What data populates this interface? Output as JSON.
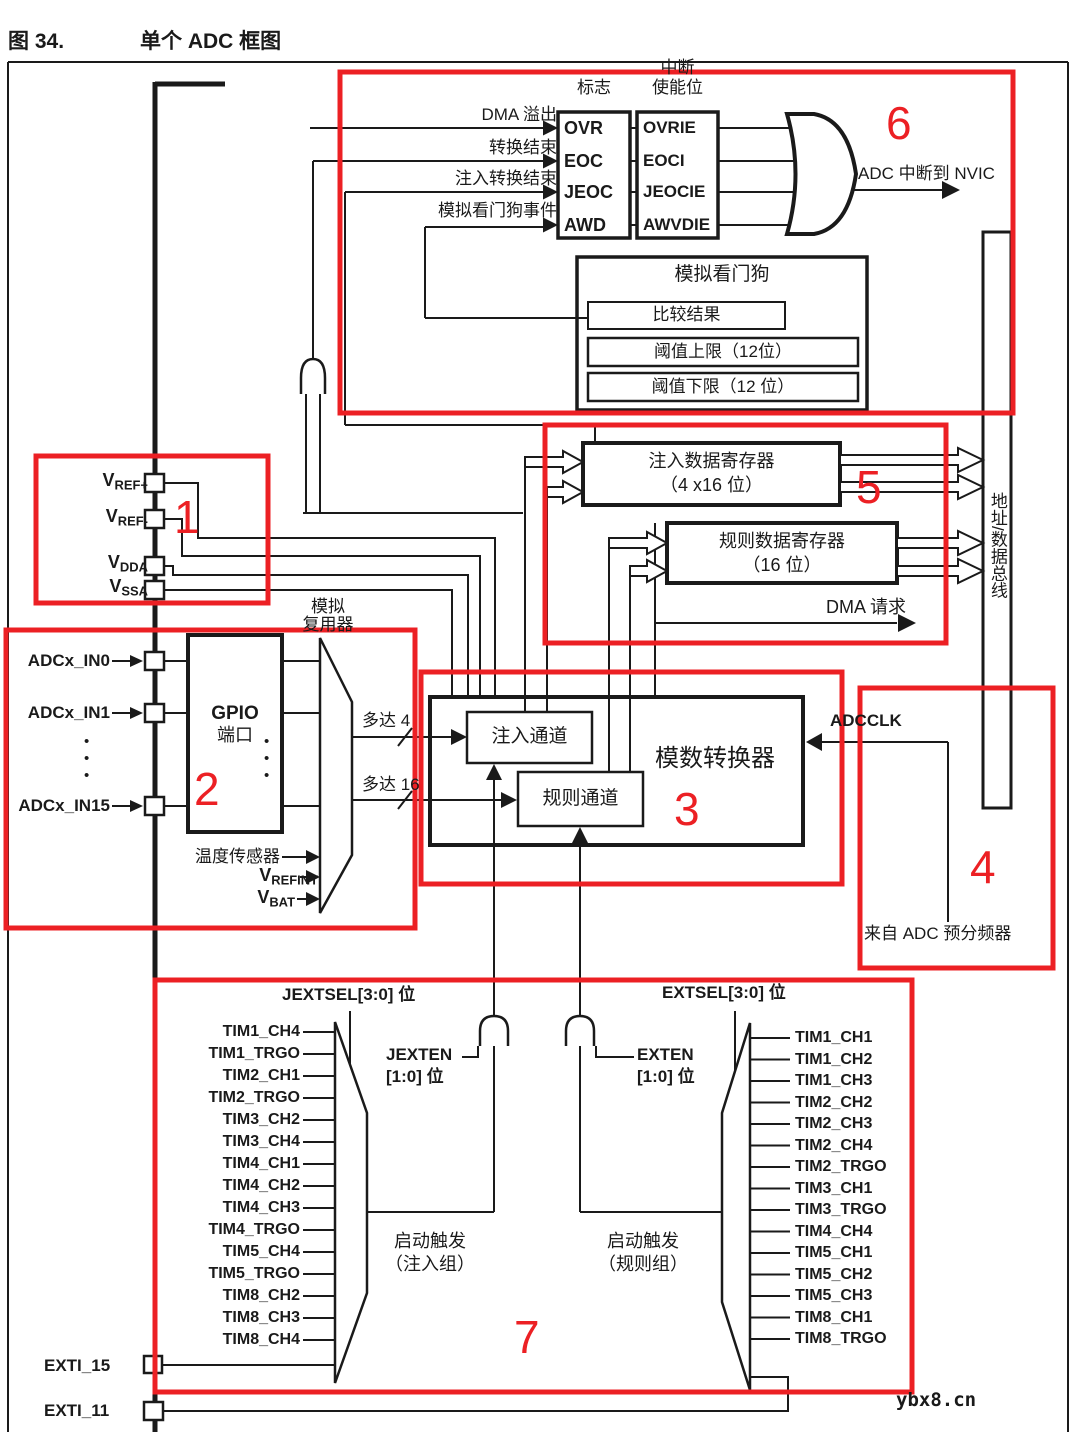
{
  "title": {
    "figure_label": "图 34.",
    "figure_title": "单个 ADC 框图"
  },
  "colors": {
    "annotation_red": "#ec2024",
    "line_black": "#1a1a1a"
  },
  "watermark": "ybx8.cn",
  "interrupt_section": {
    "flags_header": "标志",
    "enable_header_line1": "中断",
    "enable_header_line2": "使能位",
    "rows": [
      {
        "event": "DMA 溢出",
        "flag": "OVR",
        "enable": "OVRIE"
      },
      {
        "event": "转换结束",
        "flag": "EOC",
        "enable": "EOCI"
      },
      {
        "event": "注入转换结束",
        "flag": "JEOC",
        "enable": "JEOCIE"
      },
      {
        "event": "模拟看门狗事件",
        "flag": "AWD",
        "enable": "AWVDIE"
      }
    ],
    "output_label": "ADC 中断到 NVIC"
  },
  "watchdog": {
    "title": "模拟看门狗",
    "compare_result": "比较结果",
    "upper_threshold": "阈值上限（12位）",
    "lower_threshold": "阈值下限（12 位）"
  },
  "registers": {
    "injected_line1": "注入数据寄存器",
    "injected_line2": "（4 x16 位）",
    "regular_line1": "规则数据寄存器",
    "regular_line2": "（16 位）",
    "dma_request": "DMA 请求",
    "bus_label": "地址/数据总线"
  },
  "power_pins": [
    {
      "base": "V",
      "sub": "REF+"
    },
    {
      "base": "V",
      "sub": "REF-"
    },
    {
      "base": "V",
      "sub": "DDA"
    },
    {
      "base": "V",
      "sub": "SSA"
    }
  ],
  "analog_inputs": {
    "in0": "ADCx_IN0",
    "in1": "ADCx_IN1",
    "in15": "ADCx_IN15",
    "gpio_line1": "GPIO",
    "gpio_line2": "端口",
    "mux_label_line1": "模拟",
    "mux_label_line2": "复用器",
    "up_to_4": "多达 4",
    "up_to_16": "多达 16",
    "temp_sensor": "温度传感器",
    "vrefint_base": "V",
    "vrefint_sub": "REFINT",
    "vbat_base": "V",
    "vbat_sub": "BAT"
  },
  "adc_core": {
    "title": "模数转换器",
    "injected": "注入通道",
    "regular": "规则通道"
  },
  "clock": {
    "adcclk": "ADCCLK",
    "source": "来自 ADC 预分频器"
  },
  "triggers": {
    "jextsel": "JEXTSEL[3:0] 位",
    "extsel": "EXTSEL[3:0] 位",
    "jexten_line1": "JEXTEN",
    "jexten_line2": "[1:0] 位",
    "exten_line1": "EXTEN",
    "exten_line2": "[1:0] 位",
    "injected_trigger_line1": "启动触发",
    "injected_trigger_line2": "（注入组）",
    "regular_trigger_line1": "启动触发",
    "regular_trigger_line2": "（规则组）",
    "injected_inputs": [
      "TIM1_CH4",
      "TIM1_TRGO",
      "TIM2_CH1",
      "TIM2_TRGO",
      "TIM3_CH2",
      "TIM3_CH4",
      "TIM4_CH1",
      "TIM4_CH2",
      "TIM4_CH3",
      "TIM4_TRGO",
      "TIM5_CH4",
      "TIM5_TRGO",
      "TIM8_CH2",
      "TIM8_CH3",
      "TIM8_CH4"
    ],
    "regular_inputs": [
      "TIM1_CH1",
      "TIM1_CH2",
      "TIM1_CH3",
      "TIM2_CH2",
      "TIM2_CH3",
      "TIM2_CH4",
      "TIM2_TRGO",
      "TIM3_CH1",
      "TIM3_TRGO",
      "TIM4_CH4",
      "TIM5_CH1",
      "TIM5_CH2",
      "TIM5_CH3",
      "TIM8_CH1",
      "TIM8_TRGO"
    ],
    "exti15": "EXTI_15",
    "exti11": "EXTI_11"
  },
  "annotations": [
    "1",
    "2",
    "3",
    "4",
    "5",
    "6",
    "7"
  ]
}
